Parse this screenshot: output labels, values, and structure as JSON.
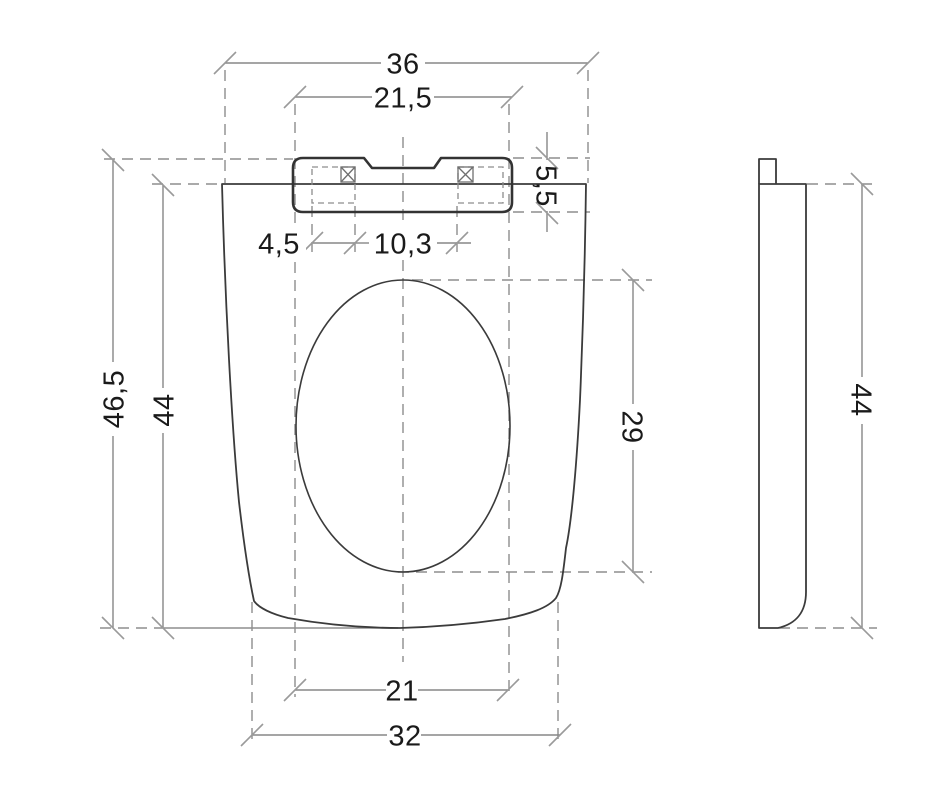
{
  "drawing": {
    "type": "toilet-seat-dimension-drawing",
    "views": [
      "front",
      "side"
    ]
  },
  "dims": {
    "overall_width": "36",
    "hinge_bar_width": "21,5",
    "hinge_bar_depth": "5,5",
    "fixing_plate_width": "4,5",
    "fixing_plate_spacing": "10,3",
    "overall_depth": "46,5",
    "seat_depth": "44",
    "cutout_length": "29",
    "cutout_width": "21",
    "bottom_width": "32",
    "side_height": "44"
  }
}
